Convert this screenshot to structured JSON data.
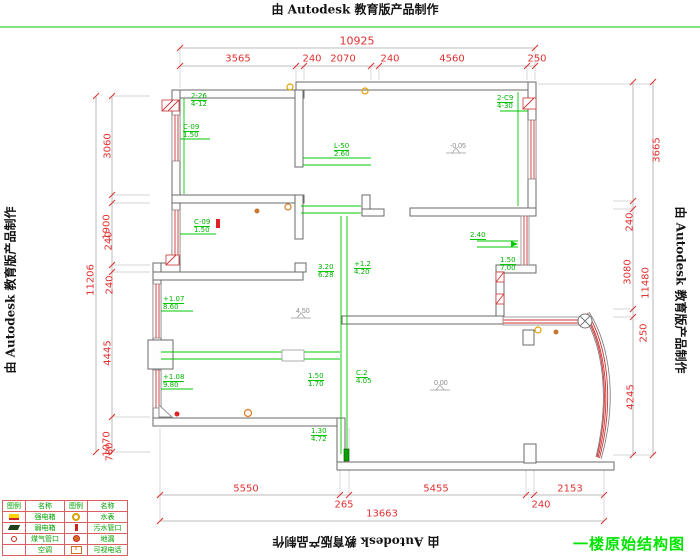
{
  "watermark": {
    "top": "由 Autodesk 教育版产品制作",
    "bottom": "由 Autodesk 教育版产品制作",
    "left": "由 Autodesk 教育版产品制作",
    "right": "由 Autodesk 教育版产品制作"
  },
  "title": {
    "text": "一楼原始结构图",
    "color": "#00e400"
  },
  "colors": {
    "dimension_text": "#e03030",
    "wall_line": "#6a6a6a",
    "window_line": "#cc3333",
    "beam_line": "#00c800",
    "annotation_text": "#00b400",
    "title_green": "#00e400"
  },
  "dims": {
    "top": {
      "total": "10925",
      "s1": "3565",
      "s2": "240",
      "s3": "2070",
      "s4": "240",
      "s5": "4560",
      "s6": "250"
    },
    "left": {
      "total": "11206",
      "s1": "3060",
      "s2": "1900",
      "s3": "240",
      "s4": "240",
      "s5": "4445",
      "s6": "1070",
      "s7": "780"
    },
    "right": {
      "total": "11480",
      "s1": "3665",
      "s2": "240",
      "s3": "3080",
      "s4": "250",
      "s5": "4245"
    },
    "bottom": {
      "total": "13663",
      "s1": "5550",
      "s2": "265",
      "s3": "5455",
      "s4": "240",
      "s5": "2153"
    }
  },
  "annotations": {
    "a1": {
      "line1": "2-26",
      "line2": "4-12"
    },
    "a2": {
      "line1": "C-09",
      "line2": "1.50"
    },
    "a3": {
      "line1": "C-09",
      "line2": "1.50"
    },
    "a4": {
      "line1": "L-50",
      "line2": "2.60"
    },
    "a5": {
      "line1": "2-C9",
      "line2": "4-30"
    },
    "a6": {
      "line1": "3.20",
      "line2": "6.28"
    },
    "a6b": {
      "line1": "+1.2",
      "line2": "4.20"
    },
    "a7": {
      "line1": "1.50",
      "line2": "7.00"
    },
    "a8": {
      "line1": "2.40",
      "line2": ""
    },
    "a9": {
      "line1": "+1.07",
      "line2": "8.60"
    },
    "a10": {
      "line1": "+1.08",
      "line2": "9.80"
    },
    "a11": {
      "line1": "C.2",
      "line2": "4.05"
    },
    "a12": {
      "line1": "1.50",
      "line2": "1.70"
    },
    "a13": {
      "line1": "1.30",
      "line2": "4.72"
    }
  },
  "levels": {
    "v1": "-0.05",
    "v2": "0.00",
    "v3": "4.50"
  },
  "legend": {
    "headers": [
      "图例",
      "名称",
      "图例",
      "名称"
    ],
    "rows": [
      {
        "name1": "强电箱",
        "name2": "水表"
      },
      {
        "name1": "弱电箱",
        "name2": "污水管口"
      },
      {
        "name1": "煤气管口",
        "name2": "地漏"
      },
      {
        "name1": "空调",
        "name2": "可视电话"
      }
    ],
    "phone_x": "x"
  }
}
